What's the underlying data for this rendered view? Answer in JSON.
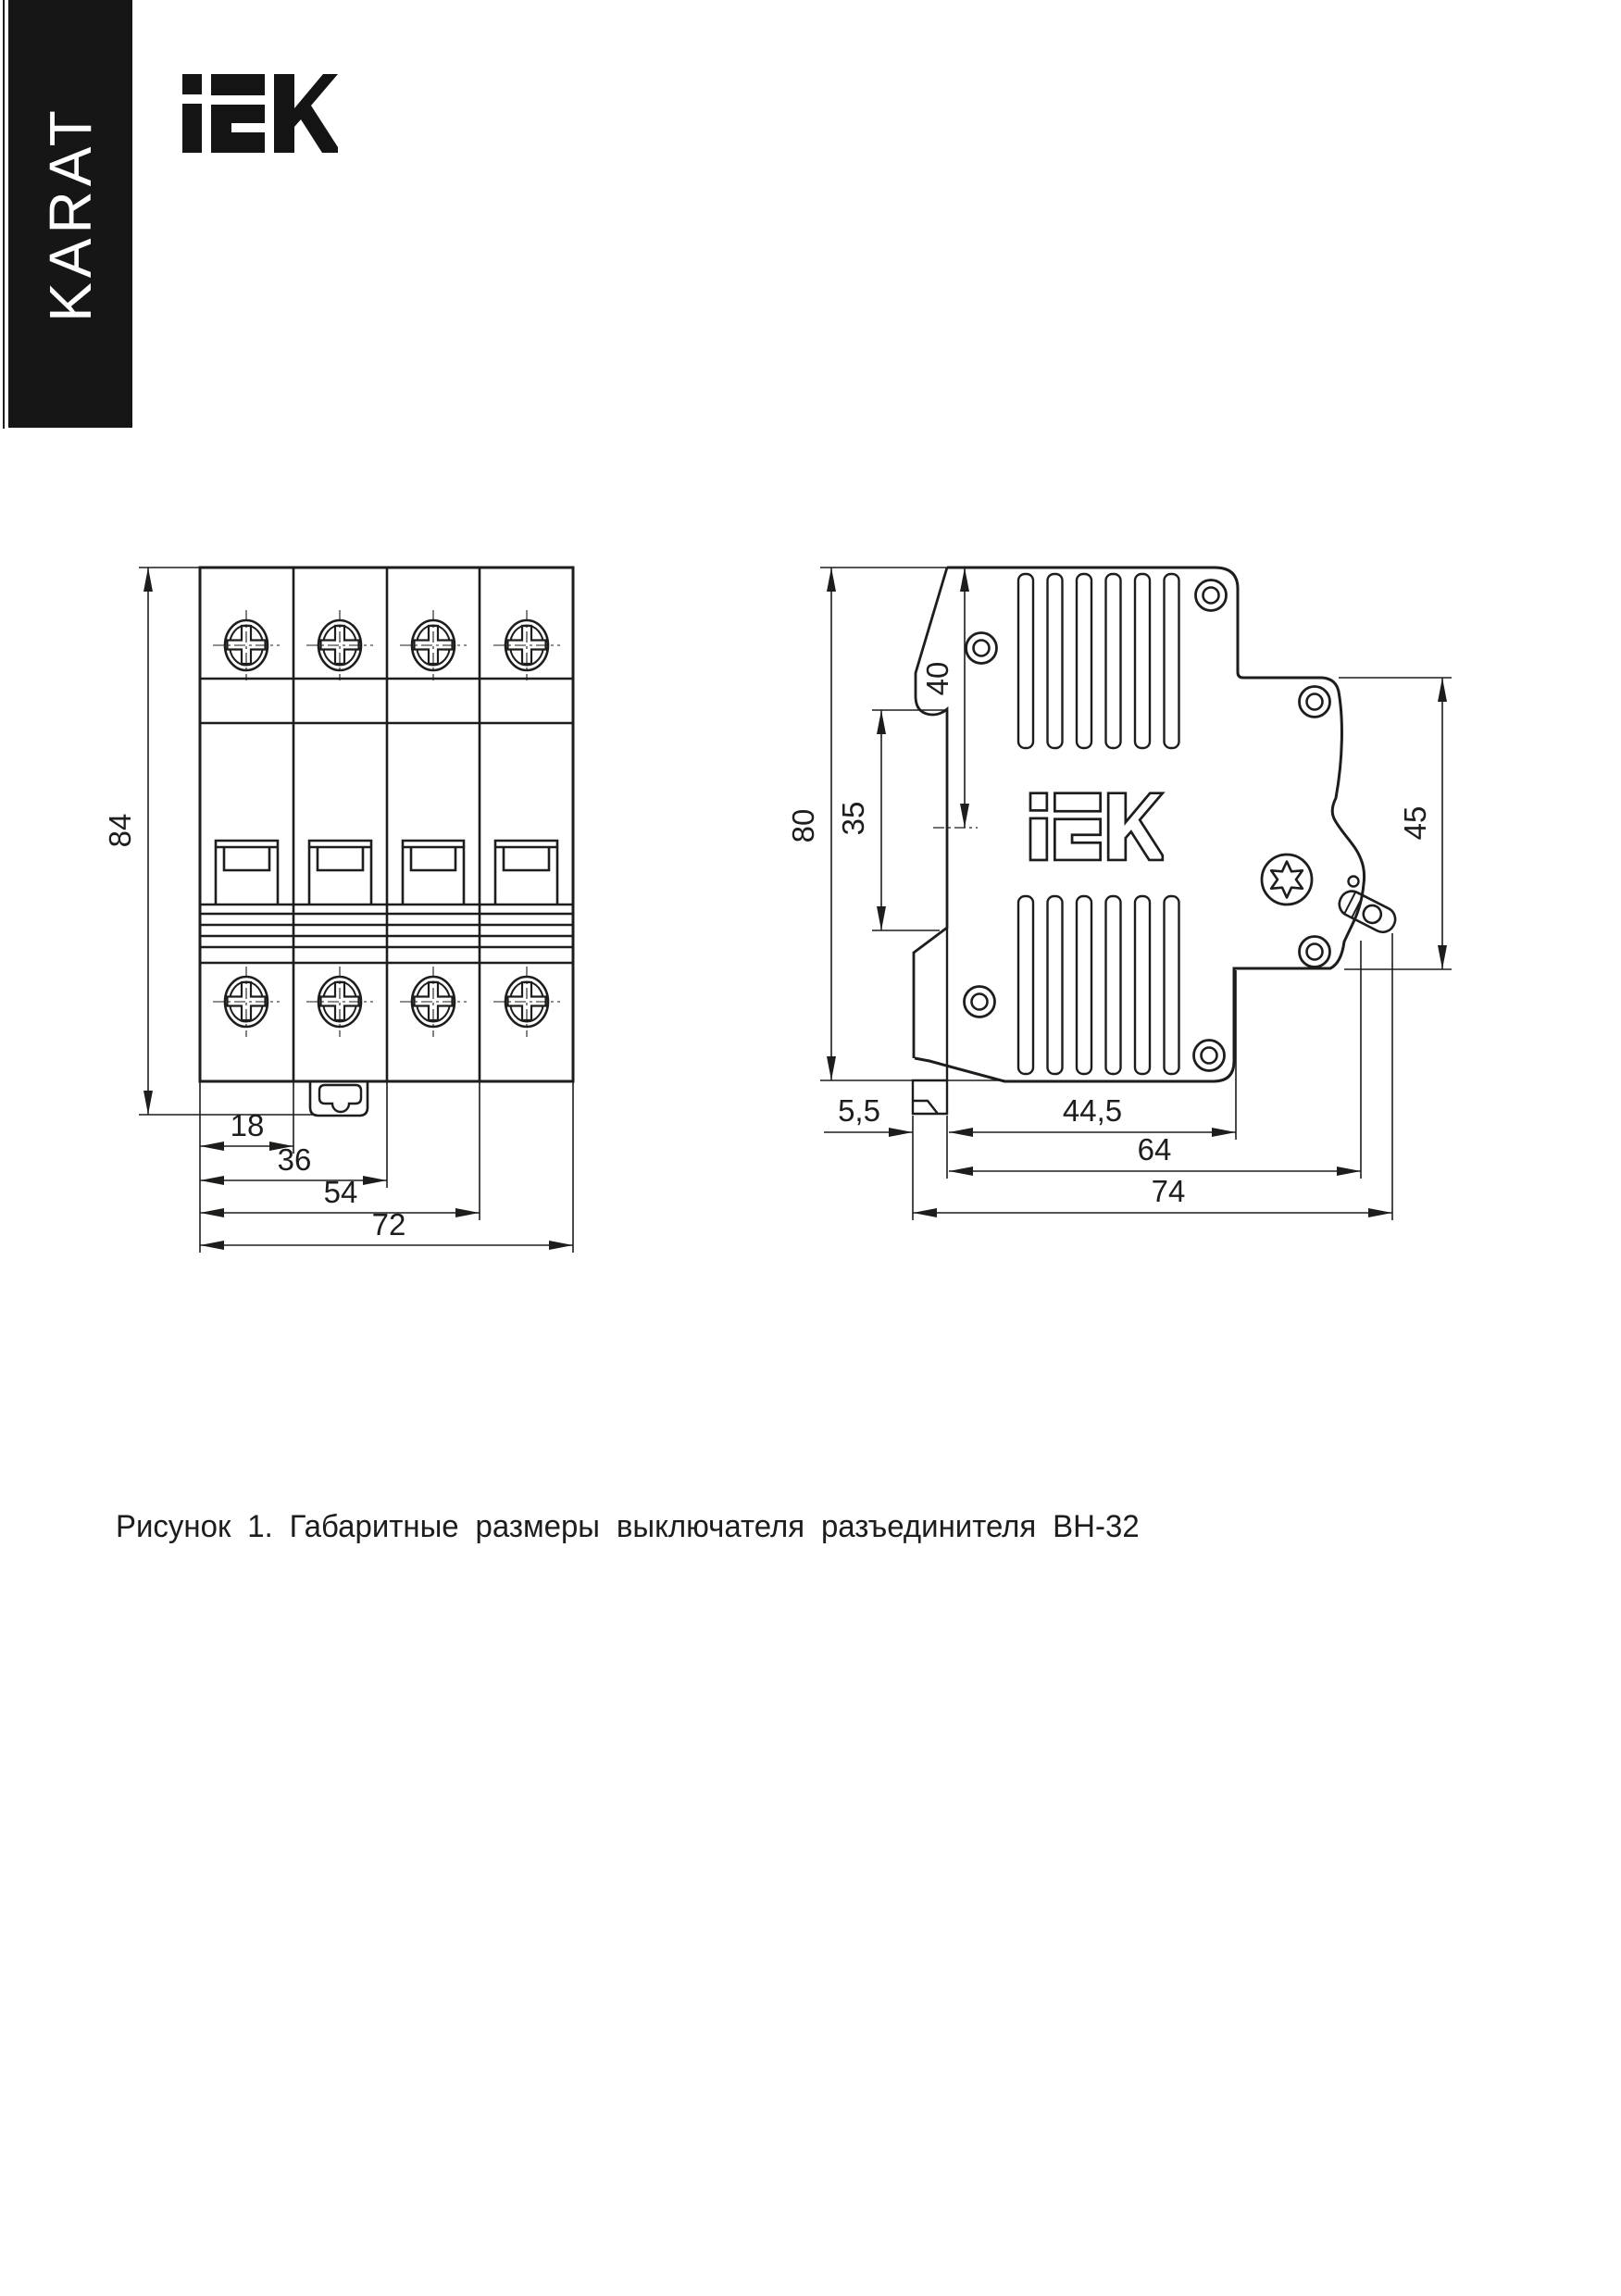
{
  "sidebar": {
    "brand": "KARAT"
  },
  "header": {
    "logo_text": "iEK"
  },
  "icons": {
    "logo": "iek-logo",
    "screw": "phillips-screw-icon",
    "boss": "screw-boss-icon",
    "torx": "torx-screw-icon"
  },
  "caption": {
    "text": "Рисунок 1. Габаритные размеры выключателя разъединителя ВН-32"
  },
  "front_view": {
    "title": "front-view-vn32",
    "dims": {
      "height": "84",
      "module_width": "18",
      "two_modules": "36",
      "three_modules": "54",
      "total_width": "72"
    }
  },
  "side_view": {
    "title": "side-view-vn32",
    "dims": {
      "body_height": "80",
      "handle_offset": "40",
      "rail_height": "35",
      "front_height": "45",
      "clip_depth": "5,5",
      "case_depth": "44,5",
      "body_depth": "64",
      "total_depth": "74"
    }
  }
}
